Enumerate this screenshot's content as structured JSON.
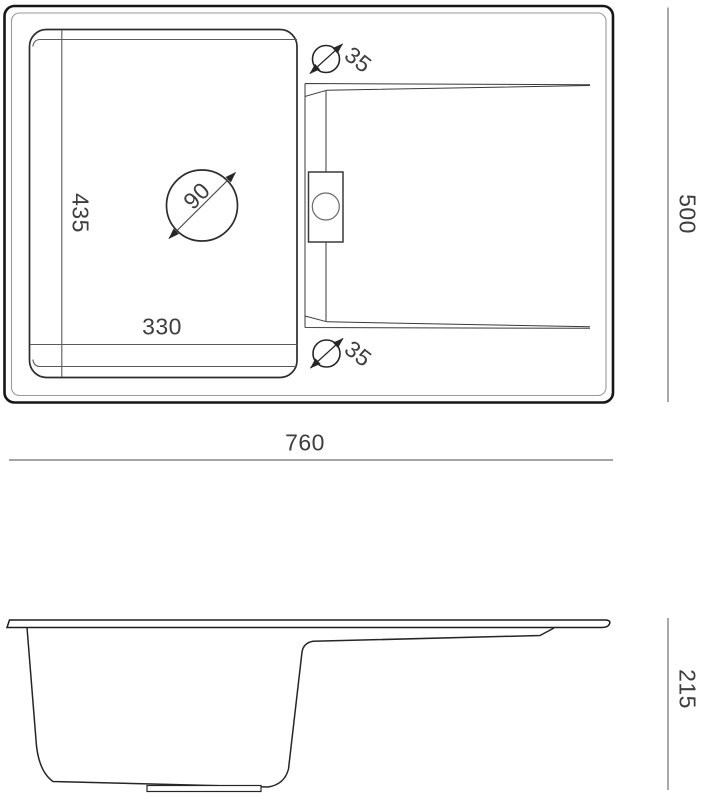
{
  "drawing": {
    "type": "sink-technical-drawing",
    "views": {
      "top": {
        "overall_width": "760",
        "overall_depth": "500",
        "bowl_width": "330",
        "bowl_depth": "435",
        "drain_hole_diameter": "90",
        "tap_hole_top_diameter": "35",
        "tap_hole_bottom_diameter": "35"
      },
      "side": {
        "height": "215"
      }
    },
    "colors": {
      "outline": "#1a1a1a",
      "thin_line": "#5a5a5a",
      "frame_inner_line": "#9a9a9a",
      "dimension_line": "#6e6e6e",
      "text": "#3e3e3e",
      "background": "#ffffff"
    }
  }
}
